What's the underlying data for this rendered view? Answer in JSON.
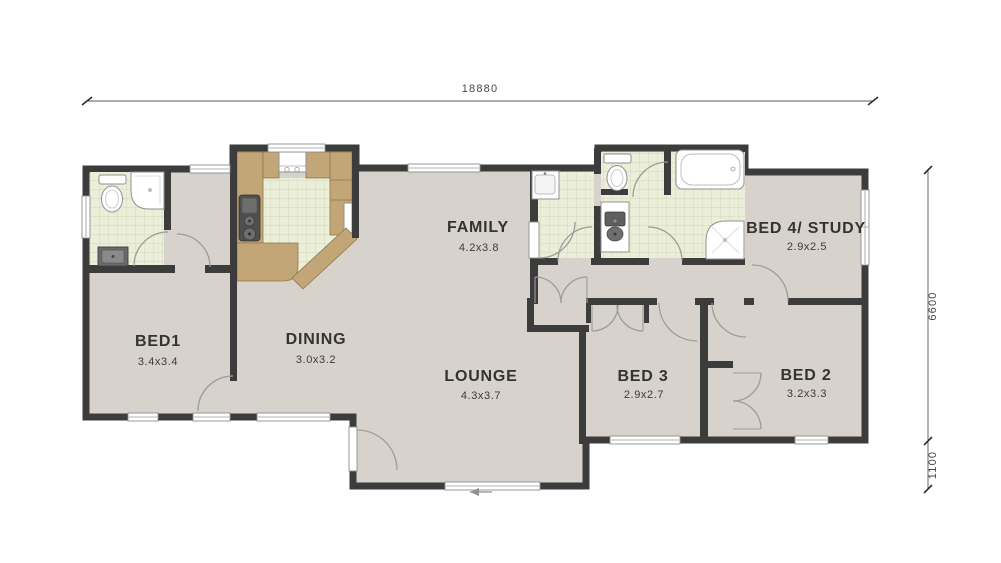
{
  "plan": {
    "type": "floor-plan",
    "dimensions": {
      "overall_width": "18880",
      "right_upper": "6600",
      "right_lower": "1100"
    },
    "rooms": {
      "bed1": {
        "name": "BED1",
        "size": "3.4x3.4"
      },
      "dining": {
        "name": "DINING",
        "size": "3.0x3.2"
      },
      "family": {
        "name": "FAMILY",
        "size": "4.2x3.8"
      },
      "lounge": {
        "name": "LOUNGE",
        "size": "4.3x3.7"
      },
      "bed3": {
        "name": "BED 3",
        "size": "2.9x2.7"
      },
      "bed2": {
        "name": "BED 2",
        "size": "3.2x3.3"
      },
      "bed4": {
        "name": "BED 4/ STUDY",
        "size": "2.9x2.5"
      }
    },
    "colors": {
      "wall": "#3c3c3c",
      "floor": "#d7d2cc",
      "tile": "#ebeed8",
      "tile_grid": "#ccd0b2",
      "counter": "#c3a678",
      "label": "#333330",
      "dimension": "#474747"
    }
  }
}
